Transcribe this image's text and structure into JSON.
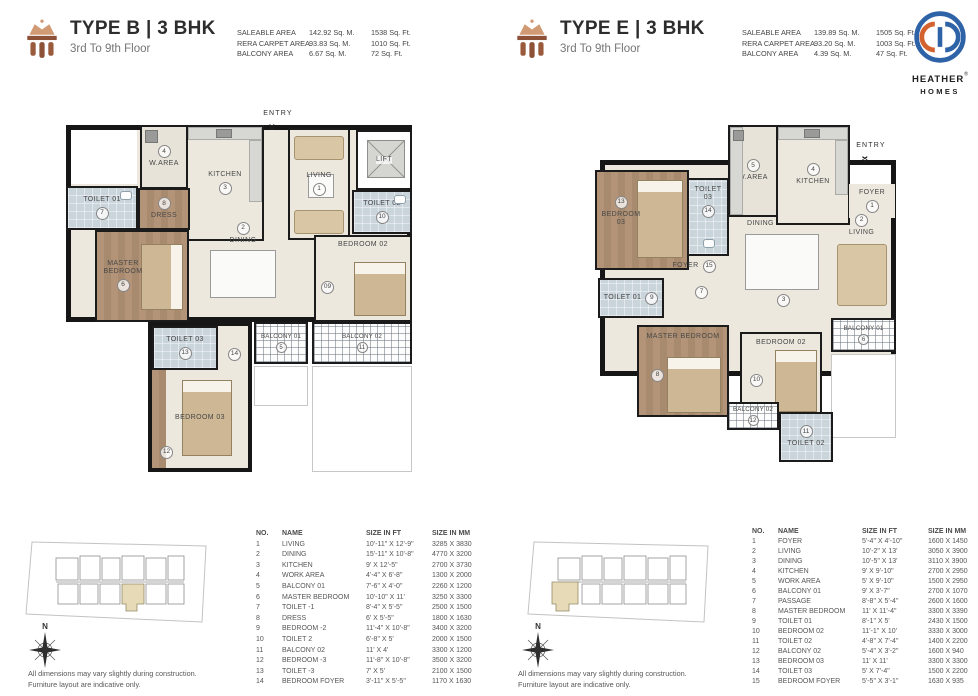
{
  "logo": {
    "line1": "HEATHER",
    "reg": "®",
    "line2": "HOMES"
  },
  "units": [
    {
      "title": "TYPE B | 3 BHK",
      "subtitle": "3rd To 9th Floor",
      "areas": [
        {
          "label": "SALEABLE AREA",
          "sqm": "142.92 Sq. M.",
          "sqft": "1538 Sq. Ft."
        },
        {
          "label": "RERA CARPET AREA",
          "sqm": "93.83 Sq. M.",
          "sqft": "1010 Sq. Ft."
        },
        {
          "label": "BALCONY AREA",
          "sqm": "6.67 Sq. M.",
          "sqft": "72 Sq. Ft."
        }
      ],
      "plan": {
        "entry": "ENTRY",
        "lift": "LIFT",
        "warea": {
          "name": "W.AREA",
          "num": "4"
        },
        "kitchen": {
          "name": "KITCHEN",
          "num": "3"
        },
        "living": {
          "name": "LIVING",
          "num": "1"
        },
        "toilet1": {
          "name": "TOILET 01",
          "num": "7"
        },
        "dress": {
          "name": "DRESS",
          "num": "8"
        },
        "toilet2": {
          "name": "TOILET 02",
          "num": "10"
        },
        "master": {
          "name": "MASTER BEDROOM",
          "num": "6"
        },
        "dining": {
          "name": "DINING",
          "num": "2"
        },
        "bedroom2": {
          "name": "BEDROOM 02",
          "num": "09"
        },
        "balcony1": {
          "name": "BALCONY 01",
          "num": "5"
        },
        "balcony2": {
          "name": "BALCONY 02",
          "num": "11"
        },
        "toilet3": {
          "name": "TOILET 03",
          "num": "13"
        },
        "foyer": {
          "num": "14"
        },
        "bedroom3": {
          "name": "BEDROOM 03",
          "num": "12"
        }
      },
      "table": {
        "headers": [
          "NO.",
          "NAME",
          "SIZE IN FT",
          "SIZE IN MM"
        ],
        "rows": [
          [
            "1",
            "LIVING",
            "10'-11\" X 12'-9\"",
            "3285 X 3830"
          ],
          [
            "2",
            "DINING",
            "15'-11\" X 10'-8\"",
            "4770 X 3200"
          ],
          [
            "3",
            "KITCHEN",
            "9' X 12'-5\"",
            "2700 X 3730"
          ],
          [
            "4",
            "WORK AREA",
            "4'-4\" X 6'-8\"",
            "1300 X 2000"
          ],
          [
            "5",
            "BALCONY 01",
            "7'-6\" X 4'-0\"",
            "2260 X 1200"
          ],
          [
            "6",
            "MASTER BEDROOM",
            "10'-10\" X 11'",
            "3250 X 3300"
          ],
          [
            "7",
            "TOILET -1",
            "8'-4\" X 5'-5\"",
            "2500 X 1500"
          ],
          [
            "8",
            "DRESS",
            "6' X 5'-5\"",
            "1800 X 1630"
          ],
          [
            "9",
            "BEDROOM -2",
            "11'-4\" X 10'-8\"",
            "3400 X 3200"
          ],
          [
            "10",
            "TOILET 2",
            "6'-8\" X 5'",
            "2000 X 1500"
          ],
          [
            "11",
            "BALCONY 02",
            "11' X 4'",
            "3300 X 1200"
          ],
          [
            "12",
            "BEDROOM -3",
            "11'-8\" X 10'-8\"",
            "3500 X 3200"
          ],
          [
            "13",
            "TOILET -3",
            "7' X 5'",
            "2100 X 1500"
          ],
          [
            "14",
            "BEDROOM FOYER",
            "3'-11\" X 5'-5\"",
            "1170 X 1630"
          ]
        ]
      },
      "compass_north": "N",
      "disclaimer1": "All dimensions may vary slightly during construction.",
      "disclaimer2": "Furniture layout are indicative only."
    },
    {
      "title": "TYPE E | 3 BHK",
      "subtitle": "3rd To 9th Floor",
      "areas": [
        {
          "label": "SALEABLE AREA",
          "sqm": "139.89 Sq. M.",
          "sqft": "1505 Sq. Ft."
        },
        {
          "label": "RERA CARPET AREA",
          "sqm": "93.20 Sq. M.",
          "sqft": "1003 Sq. Ft."
        },
        {
          "label": "BALCONY AREA",
          "sqm": "4.39 Sq. M.",
          "sqft": "47 Sq. Ft."
        }
      ],
      "plan": {
        "entry": "ENTRY",
        "warea": {
          "name": "W.AREA",
          "num": "5"
        },
        "kitchen": {
          "name": "KITCHEN",
          "num": "4"
        },
        "foyer1": {
          "name": "FOYER",
          "num": "1"
        },
        "living": {
          "name": "LIVING",
          "num": "2"
        },
        "dining": {
          "name": "DINING",
          "num": "3"
        },
        "bedroom3": {
          "name": "BEDROOM 03",
          "num": "13"
        },
        "toilet3": {
          "name": "TOILET 03",
          "num": "14"
        },
        "foyer15": {
          "name": "FOYER",
          "num": "15"
        },
        "toilet1": {
          "name": "TOILET 01",
          "num": "9"
        },
        "passage": {
          "num": "7"
        },
        "master": {
          "name": "MASTER BEDROOM",
          "num": "8"
        },
        "bedroom2": {
          "name": "BEDROOM 02",
          "num": "10"
        },
        "balcony1": {
          "name": "BALCONY 01",
          "num": "6"
        },
        "balcony2": {
          "name": "BALCONY 02",
          "num": "12"
        },
        "toilet2": {
          "name": "TOILET 02",
          "num": "11"
        }
      },
      "table": {
        "headers": [
          "NO.",
          "NAME",
          "SIZE IN FT",
          "SIZE IN MM"
        ],
        "rows": [
          [
            "1",
            "FOYER",
            "5'-4\" X 4'-10\"",
            "1600 X 1450"
          ],
          [
            "2",
            "LIVING",
            "10'-2\" X 13'",
            "3050 X 3900"
          ],
          [
            "3",
            "DINING",
            "10'-5\" X 13'",
            "3110 X 3900"
          ],
          [
            "4",
            "KITCHEN",
            "9' X 9'-10\"",
            "2700 X 2950"
          ],
          [
            "5",
            "WORK AREA",
            "5' X 9'-10\"",
            "1500 X 2950"
          ],
          [
            "6",
            "BALCONY 01",
            "9' X 3'-7\"",
            "2700 X 1070"
          ],
          [
            "7",
            "PASSAGE",
            "8'-8\" X 5'-4\"",
            "2600 X 1600"
          ],
          [
            "8",
            "MASTER BEDROOM",
            "11' X 11'-4\"",
            "3300 X 3390"
          ],
          [
            "9",
            "TOILET 01",
            "8'-1\" X 5'",
            "2430 X 1500"
          ],
          [
            "10",
            "BEDROOM 02",
            "11'-1\" X 10'",
            "3330 X 3000"
          ],
          [
            "11",
            "TOILET 02",
            "4'-8\" X 7'-4\"",
            "1400 X 2200"
          ],
          [
            "12",
            "BALCONY 02",
            "5'-4\" X 3'-2\"",
            "1600 X 940"
          ],
          [
            "13",
            "BEDROOM 03",
            "11' X 11'",
            "3300 X 3300"
          ],
          [
            "14",
            "TOILET 03",
            "5' X 7'-4\"",
            "1500 X 2200"
          ],
          [
            "15",
            "BEDROOM FOYER",
            "5'-5\" X 3'-1\"",
            "1630 X 935"
          ]
        ]
      },
      "compass_north": "N",
      "disclaimer1": "All dimensions may vary slightly during construction.",
      "disclaimer2": "Furniture layout are indicative only."
    }
  ]
}
